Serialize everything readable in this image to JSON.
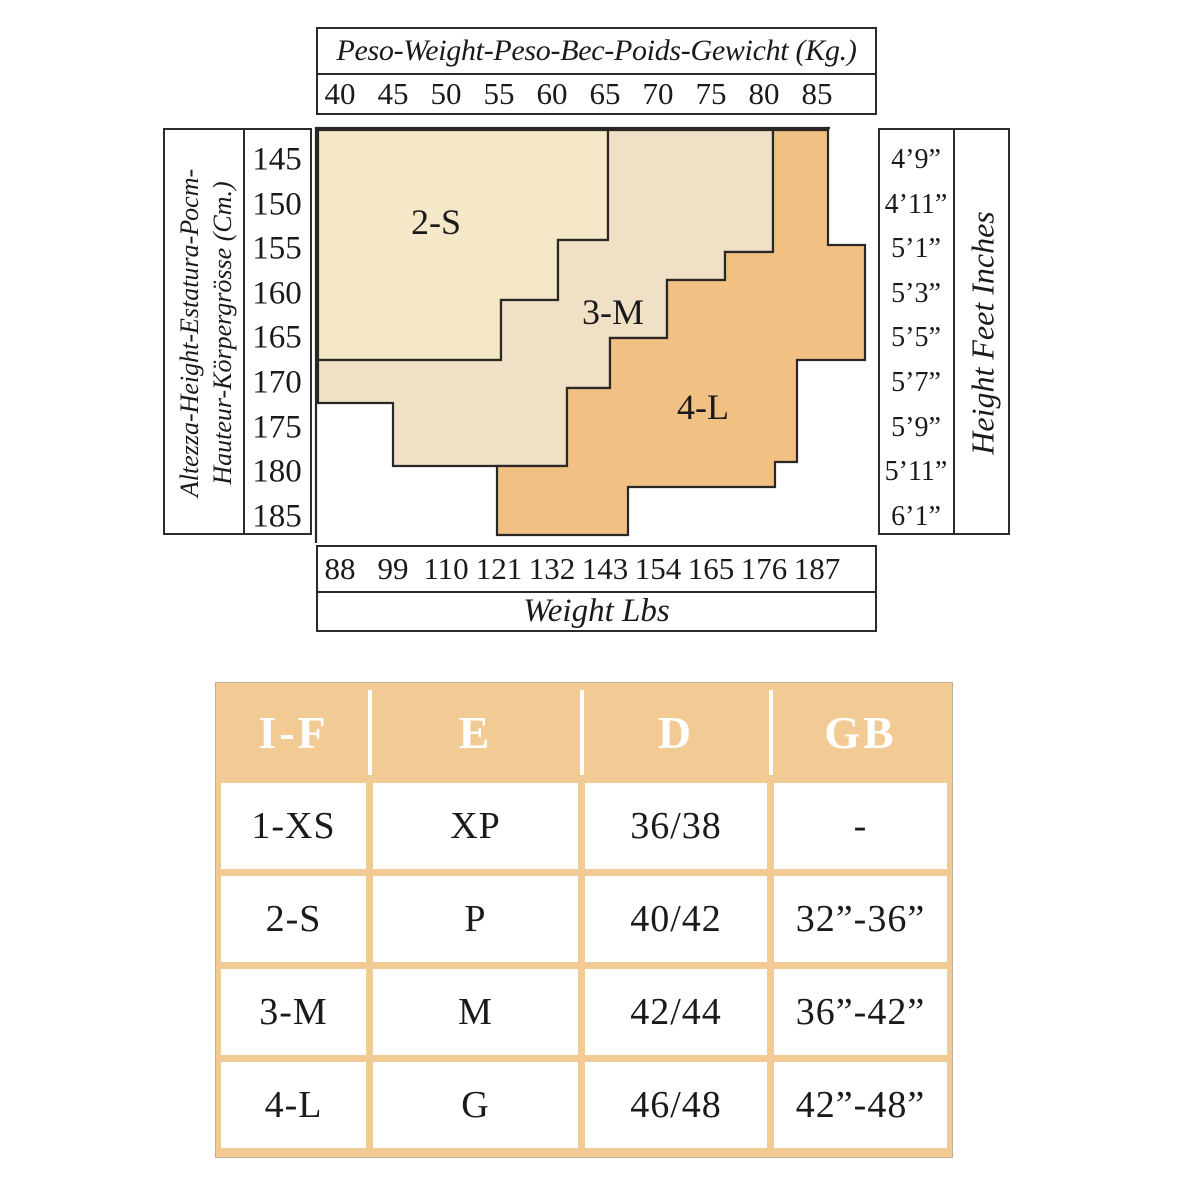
{
  "size_chart": {
    "kg_axis": {
      "title": "Peso-Weight-Peso-Bec-Poids-Gewicht (Kg.)",
      "ticks": [
        "40",
        "45",
        "50",
        "55",
        "60",
        "65",
        "70",
        "75",
        "80",
        "85"
      ]
    },
    "lbs_axis": {
      "title": "Weight Lbs",
      "ticks": [
        "88",
        "99",
        "110",
        "121",
        "132",
        "143",
        "154",
        "165",
        "176",
        "187"
      ]
    },
    "cm_axis": {
      "title_line1": "Altezza-Height-Estatura-Рост-",
      "title_line2": "Hauteur-Körpergrösse (Cm.)",
      "ticks": [
        "145",
        "150",
        "155",
        "160",
        "165",
        "170",
        "175",
        "180",
        "185"
      ]
    },
    "ft_axis": {
      "title": "Height Feet Inches",
      "ticks": [
        "4’9”",
        "4’11”",
        "5’1”",
        "5’3”",
        "5’5”",
        "5’7”",
        "5’9”",
        "5’11”",
        "6’1”"
      ]
    },
    "regions": [
      {
        "label": "2-S",
        "color": "#f4e8c8",
        "path": "M318,130 L608,130 L608,240 L558,240 L558,300 L501,300 L501,360 L318,360 Z"
      },
      {
        "label": "3-M",
        "color": "#f0e0c5",
        "path": "M608,130 L773,130 L773,252 L725,252 L725,280 L667,280 L667,338 L610,338 L610,388 L567,388 L567,466 L393,466 L393,403 L318,403 L318,360 L501,360 L501,300 L558,300 L558,240 L608,240 Z"
      },
      {
        "label": "4-L",
        "color": "#f0c183",
        "path": "M773,130 L828,130 L828,245 L865,245 L865,360 L797,360 L797,462 L775,462 L775,487 L628,487 L628,535 L497,535 L497,466 L567,466 L567,388 L610,388 L610,338 L667,338 L667,280 L725,280 L725,252 L773,252 Z"
      }
    ],
    "line_color": "#2b2724",
    "plot_border_path": "M316,543 L316,128 L830,128"
  },
  "conversion_table": {
    "header": [
      "I-F",
      "E",
      "D",
      "GB"
    ],
    "rows": [
      [
        "1-XS",
        "XP",
        "36/38",
        "-"
      ],
      [
        "2-S",
        "P",
        "40/42",
        "32”-36”"
      ],
      [
        "3-M",
        "M",
        "42/44",
        "36”-42”"
      ],
      [
        "4-L",
        "G",
        "46/48",
        "42”-48”"
      ]
    ],
    "frame_color": "#f2cb94"
  },
  "chart_data": [
    {
      "type": "heatmap",
      "title": "Peso-Weight-Peso-Bec-Poids-Gewicht (Kg.)",
      "x_axis": {
        "top_label": "Peso-Weight-Peso-Bec-Poids-Gewicht (Kg.)",
        "ticks_kg": [
          40,
          45,
          50,
          55,
          60,
          65,
          70,
          75,
          80,
          85
        ],
        "bottom_label": "Weight Lbs",
        "ticks_lbs": [
          88,
          99,
          110,
          121,
          132,
          143,
          154,
          165,
          176,
          187
        ]
      },
      "y_axis": {
        "left_label": "Altezza-Height-Estatura-Рост-Hauteur-Körpergrösse (Cm.)",
        "ticks_cm": [
          145,
          150,
          155,
          160,
          165,
          170,
          175,
          180,
          185
        ],
        "right_label": "Height Feet Inches",
        "ticks_ft_in": [
          "4’9”",
          "4’11”",
          "5’1”",
          "5’3”",
          "5’5”",
          "5’7”",
          "5’9”",
          "5’11”",
          "6’1”"
        ]
      },
      "grid": false,
      "legend_position": "none",
      "regions": [
        {
          "size": "2-S",
          "polygon_kg_cm": [
            [
              38,
              142
            ],
            [
              65,
              142
            ],
            [
              65,
              154
            ],
            [
              61,
              154
            ],
            [
              61,
              161
            ],
            [
              55,
              161
            ],
            [
              55,
              168
            ],
            [
              38,
              168
            ]
          ]
        },
        {
          "size": "3-M",
          "polygon_kg_cm": [
            [
              65,
              142
            ],
            [
              81,
              142
            ],
            [
              81,
              155
            ],
            [
              76,
              155
            ],
            [
              76,
              159
            ],
            [
              71,
              159
            ],
            [
              71,
              165
            ],
            [
              66,
              165
            ],
            [
              66,
              171
            ],
            [
              62,
              171
            ],
            [
              62,
              179
            ],
            [
              45,
              179
            ],
            [
              45,
              172
            ],
            [
              38,
              172
            ],
            [
              38,
              168
            ],
            [
              55,
              168
            ],
            [
              55,
              161
            ],
            [
              61,
              161
            ],
            [
              61,
              154
            ],
            [
              65,
              154
            ]
          ]
        },
        {
          "size": "4-L",
          "polygon_kg_cm": [
            [
              81,
              142
            ],
            [
              86,
              142
            ],
            [
              86,
              154
            ],
            [
              90,
              154
            ],
            [
              90,
              168
            ],
            [
              83,
              168
            ],
            [
              83,
              179
            ],
            [
              81,
              179
            ],
            [
              81,
              182
            ],
            [
              67,
              182
            ],
            [
              67,
              187
            ],
            [
              55,
              187
            ],
            [
              55,
              179
            ],
            [
              62,
              179
            ],
            [
              62,
              171
            ],
            [
              66,
              171
            ],
            [
              66,
              165
            ],
            [
              71,
              165
            ],
            [
              71,
              159
            ],
            [
              76,
              159
            ],
            [
              76,
              155
            ],
            [
              81,
              155
            ]
          ]
        }
      ]
    },
    {
      "type": "table",
      "columns": [
        "I-F",
        "E",
        "D",
        "GB"
      ],
      "rows": [
        [
          "1-XS",
          "XP",
          "36/38",
          "-"
        ],
        [
          "2-S",
          "P",
          "40/42",
          "32”-36”"
        ],
        [
          "3-M",
          "M",
          "42/44",
          "36”-42”"
        ],
        [
          "4-L",
          "G",
          "46/48",
          "42”-48”"
        ]
      ]
    }
  ]
}
